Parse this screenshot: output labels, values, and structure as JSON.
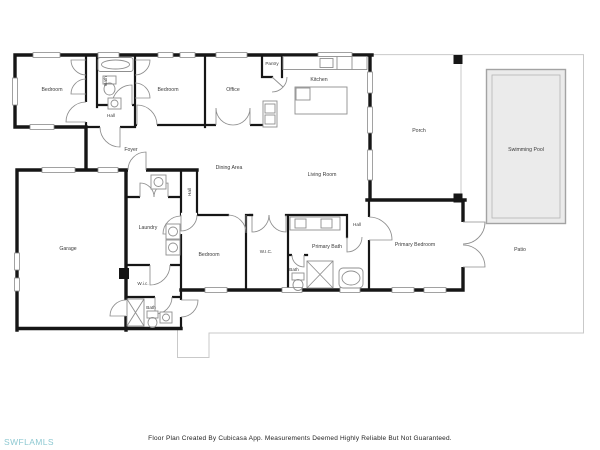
{
  "meta": {
    "width": 600,
    "height": 450,
    "app": "floor-plan-viewer"
  },
  "palette": {
    "wall": "#161616",
    "boundary": "#c9c9c9",
    "pool_fill": "#ebebeb",
    "pool_border": "#a3a3a3",
    "fixture": "#8f8f8f",
    "label": "#3a3a3a",
    "watermark": "#8ec9d2",
    "footer": "#1f1f1f"
  },
  "watermark": {
    "text": "SWFLAMLS"
  },
  "footer": {
    "text": "Floor Plan Created By Cubicasa App. Measurements Deemed Highly Reliable But Not Guaranteed."
  },
  "rooms": [
    {
      "id": "bedroom-1",
      "label": "Bedroom"
    },
    {
      "id": "bath-top",
      "label": "Bath"
    },
    {
      "id": "bedroom-2",
      "label": "Bedroom"
    },
    {
      "id": "office",
      "label": "Office"
    },
    {
      "id": "pantry",
      "label": "Pantry"
    },
    {
      "id": "kitchen",
      "label": "Kitchen"
    },
    {
      "id": "porch",
      "label": "Porch"
    },
    {
      "id": "swimming-pool",
      "label": "Swimming Pool"
    },
    {
      "id": "hall-top",
      "label": "Hall"
    },
    {
      "id": "foyer",
      "label": "Foyer"
    },
    {
      "id": "dining-area",
      "label": "Dining Area"
    },
    {
      "id": "living-room",
      "label": "Living Room"
    },
    {
      "id": "hall-middle",
      "label": "Hall"
    },
    {
      "id": "laundry",
      "label": "Laundry"
    },
    {
      "id": "garage",
      "label": "Garage"
    },
    {
      "id": "bedroom-3",
      "label": "Bedroom"
    },
    {
      "id": "wic-primary",
      "label": "W.I.C."
    },
    {
      "id": "primary-bath",
      "label": "Primary Bath"
    },
    {
      "id": "hall-primary",
      "label": "Hall"
    },
    {
      "id": "primary-bedroom",
      "label": "Primary Bedroom"
    },
    {
      "id": "patio",
      "label": "Patio"
    },
    {
      "id": "wic-2",
      "label": "W.i.c."
    },
    {
      "id": "bath-pool",
      "label": "Bath"
    },
    {
      "id": "bath-toilet-room",
      "label": "Bath"
    }
  ]
}
